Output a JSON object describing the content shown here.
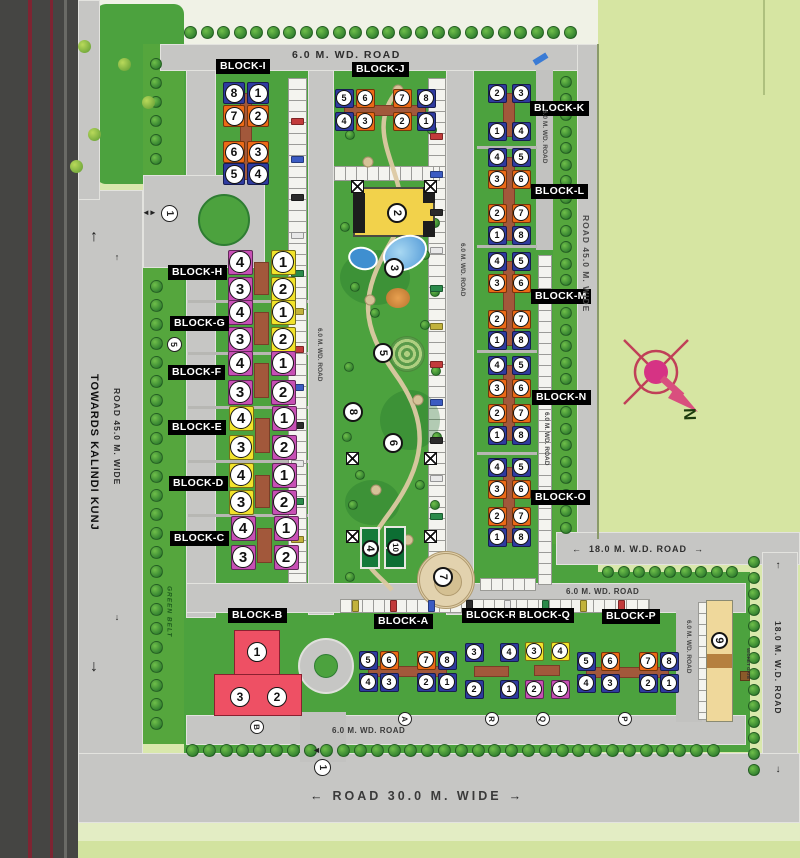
{
  "colors": {
    "blue": "#2f3ba0",
    "orange": "#ec6a17",
    "magenta": "#c750b5",
    "yellow": "#f2e32b",
    "red": "#ee5064",
    "tower": "#efd89b"
  },
  "roads": {
    "top": "6.0 M. WD. ROAD",
    "towards_kalindi": "TOWARDS KALINDI KUNJ",
    "road45_left": "ROAD 45.0 M. WIDE",
    "road45_right": "ROAD 45.0 M. WIDE",
    "road18_vertical": "18.0 M. W.D. ROAD",
    "road18_horizontal": "18.0 M. W.D. ROAD",
    "road30_bottom": "ROAD 30.0 M. WIDE",
    "wd6_near_k": "6.0 M. WD. ROAD",
    "wd6_west_of_towers": "6.0 M. WD. ROAD",
    "wd6_near_o": "6.0 M. WD. ROAD",
    "wd6_park": "6.0 M. WD. ROAD",
    "wd6_near_p": "6.0 M. WD. ROAD",
    "wd6_south_west": "6.0 M. WD. ROAD",
    "wd6_south_mid": "6.0 M. WD. ROAD",
    "green_belt": "GREEN BELT",
    "wicket_gate": "WICKET GATE",
    "north": "N"
  },
  "blocks": [
    {
      "id": "I",
      "label": "BLOCK-I",
      "units": [
        {
          "n": "8",
          "c": "blue"
        },
        {
          "n": "1",
          "c": "blue"
        },
        {
          "n": "7",
          "c": "orange"
        },
        {
          "n": "2",
          "c": "orange"
        },
        {
          "n": "6",
          "c": "orange"
        },
        {
          "n": "3",
          "c": "orange"
        },
        {
          "n": "5",
          "c": "blue"
        },
        {
          "n": "4",
          "c": "blue"
        }
      ]
    },
    {
      "id": "J",
      "label": "BLOCK-J",
      "units": [
        {
          "n": "5",
          "c": "blue"
        },
        {
          "n": "6",
          "c": "orange"
        },
        {
          "n": "7",
          "c": "orange"
        },
        {
          "n": "8",
          "c": "blue"
        },
        {
          "n": "4",
          "c": "blue"
        },
        {
          "n": "3",
          "c": "orange"
        },
        {
          "n": "2",
          "c": "orange"
        },
        {
          "n": "1",
          "c": "blue"
        }
      ]
    },
    {
      "id": "K",
      "label": "BLOCK-K",
      "units": [
        {
          "n": "2",
          "c": "blue"
        },
        {
          "n": "3",
          "c": "blue"
        },
        {
          "n": "1",
          "c": "blue"
        },
        {
          "n": "4",
          "c": "blue"
        }
      ]
    },
    {
      "id": "L",
      "label": "BLOCK-L",
      "units": [
        {
          "n": "4",
          "c": "blue"
        },
        {
          "n": "5",
          "c": "blue"
        },
        {
          "n": "3",
          "c": "orange"
        },
        {
          "n": "6",
          "c": "orange"
        },
        {
          "n": "2",
          "c": "orange"
        },
        {
          "n": "7",
          "c": "orange"
        },
        {
          "n": "1",
          "c": "blue"
        },
        {
          "n": "8",
          "c": "blue"
        }
      ]
    },
    {
      "id": "M",
      "label": "BLOCK-M",
      "units": [
        {
          "n": "4",
          "c": "blue"
        },
        {
          "n": "5",
          "c": "blue"
        },
        {
          "n": "3",
          "c": "orange"
        },
        {
          "n": "6",
          "c": "orange"
        },
        {
          "n": "2",
          "c": "orange"
        },
        {
          "n": "7",
          "c": "orange"
        },
        {
          "n": "1",
          "c": "blue"
        },
        {
          "n": "8",
          "c": "blue"
        }
      ]
    },
    {
      "id": "N",
      "label": "BLOCK-N",
      "units": [
        {
          "n": "4",
          "c": "blue"
        },
        {
          "n": "5",
          "c": "blue"
        },
        {
          "n": "3",
          "c": "orange"
        },
        {
          "n": "6",
          "c": "orange"
        },
        {
          "n": "2",
          "c": "orange"
        },
        {
          "n": "7",
          "c": "orange"
        },
        {
          "n": "1",
          "c": "blue"
        },
        {
          "n": "8",
          "c": "blue"
        }
      ]
    },
    {
      "id": "O",
      "label": "BLOCK-O",
      "units": [
        {
          "n": "4",
          "c": "blue"
        },
        {
          "n": "5",
          "c": "blue"
        },
        {
          "n": "3",
          "c": "orange"
        },
        {
          "n": "6",
          "c": "orange"
        },
        {
          "n": "2",
          "c": "orange"
        },
        {
          "n": "7",
          "c": "orange"
        },
        {
          "n": "1",
          "c": "blue"
        },
        {
          "n": "8",
          "c": "blue"
        }
      ]
    },
    {
      "id": "H",
      "label": "BLOCK-H",
      "units": [
        {
          "n": "4",
          "c": "magenta"
        },
        {
          "n": "1",
          "c": "yellow"
        },
        {
          "n": "3",
          "c": "magenta"
        },
        {
          "n": "2",
          "c": "yellow"
        }
      ]
    },
    {
      "id": "G",
      "label": "BLOCK-G",
      "units": [
        {
          "n": "4",
          "c": "magenta"
        },
        {
          "n": "1",
          "c": "yellow"
        },
        {
          "n": "3",
          "c": "magenta"
        },
        {
          "n": "2",
          "c": "yellow"
        }
      ]
    },
    {
      "id": "F",
      "label": "BLOCK-F",
      "units": [
        {
          "n": "4",
          "c": "magenta"
        },
        {
          "n": "1",
          "c": "magenta"
        },
        {
          "n": "3",
          "c": "magenta"
        },
        {
          "n": "2",
          "c": "magenta"
        }
      ]
    },
    {
      "id": "E",
      "label": "BLOCK-E",
      "units": [
        {
          "n": "4",
          "c": "yellow"
        },
        {
          "n": "1",
          "c": "magenta"
        },
        {
          "n": "3",
          "c": "yellow"
        },
        {
          "n": "2",
          "c": "magenta"
        }
      ]
    },
    {
      "id": "D",
      "label": "BLOCK-D",
      "units": [
        {
          "n": "4",
          "c": "yellow"
        },
        {
          "n": "1",
          "c": "magenta"
        },
        {
          "n": "3",
          "c": "yellow"
        },
        {
          "n": "2",
          "c": "magenta"
        }
      ]
    },
    {
      "id": "C",
      "label": "BLOCK-C",
      "units": [
        {
          "n": "4",
          "c": "magenta"
        },
        {
          "n": "1",
          "c": "magenta"
        },
        {
          "n": "3",
          "c": "magenta"
        },
        {
          "n": "2",
          "c": "magenta"
        }
      ]
    },
    {
      "id": "B",
      "label": "BLOCK-B",
      "units": [
        {
          "n": "1",
          "c": "red"
        },
        {
          "n": "3",
          "c": "red"
        },
        {
          "n": "2",
          "c": "red"
        }
      ]
    },
    {
      "id": "A",
      "label": "BLOCK-A",
      "units": [
        {
          "n": "5",
          "c": "blue"
        },
        {
          "n": "6",
          "c": "orange"
        },
        {
          "n": "7",
          "c": "orange"
        },
        {
          "n": "8",
          "c": "blue"
        },
        {
          "n": "4",
          "c": "blue"
        },
        {
          "n": "3",
          "c": "blue"
        },
        {
          "n": "2",
          "c": "blue"
        },
        {
          "n": "1",
          "c": "blue"
        }
      ]
    },
    {
      "id": "R",
      "label": "BLOCK-R",
      "units": [
        {
          "n": "3",
          "c": "blue"
        },
        {
          "n": "4",
          "c": "blue"
        },
        {
          "n": "2",
          "c": "blue"
        },
        {
          "n": "1",
          "c": "blue"
        }
      ]
    },
    {
      "id": "Q",
      "label": "BLOCK-Q",
      "units": [
        {
          "n": "3",
          "c": "yellow"
        },
        {
          "n": "4",
          "c": "yellow"
        },
        {
          "n": "2",
          "c": "magenta"
        },
        {
          "n": "1",
          "c": "magenta"
        }
      ]
    },
    {
      "id": "P",
      "label": "BLOCK-P",
      "units": [
        {
          "n": "5",
          "c": "blue"
        },
        {
          "n": "6",
          "c": "orange"
        },
        {
          "n": "7",
          "c": "orange"
        },
        {
          "n": "8",
          "c": "blue"
        },
        {
          "n": "4",
          "c": "blue"
        },
        {
          "n": "3",
          "c": "blue"
        },
        {
          "n": "2",
          "c": "blue"
        },
        {
          "n": "1",
          "c": "blue"
        }
      ]
    }
  ],
  "amenities": [
    {
      "id": "club-house",
      "n": "2"
    },
    {
      "id": "swimming-pool",
      "n": "3"
    },
    {
      "id": "central-garden",
      "n": "5"
    },
    {
      "id": "park-path",
      "n": "8"
    },
    {
      "id": "great-lawn",
      "n": "6"
    },
    {
      "id": "court-a",
      "n": "4"
    },
    {
      "id": "court-b",
      "n": "10"
    },
    {
      "id": "plaza",
      "n": "7"
    },
    {
      "id": "tower-9",
      "n": "9"
    }
  ],
  "gates": {
    "west": "1",
    "south": "1",
    "belt_marker": "5"
  },
  "road_markers": [
    "A",
    "R",
    "Q",
    "P",
    "B"
  ]
}
